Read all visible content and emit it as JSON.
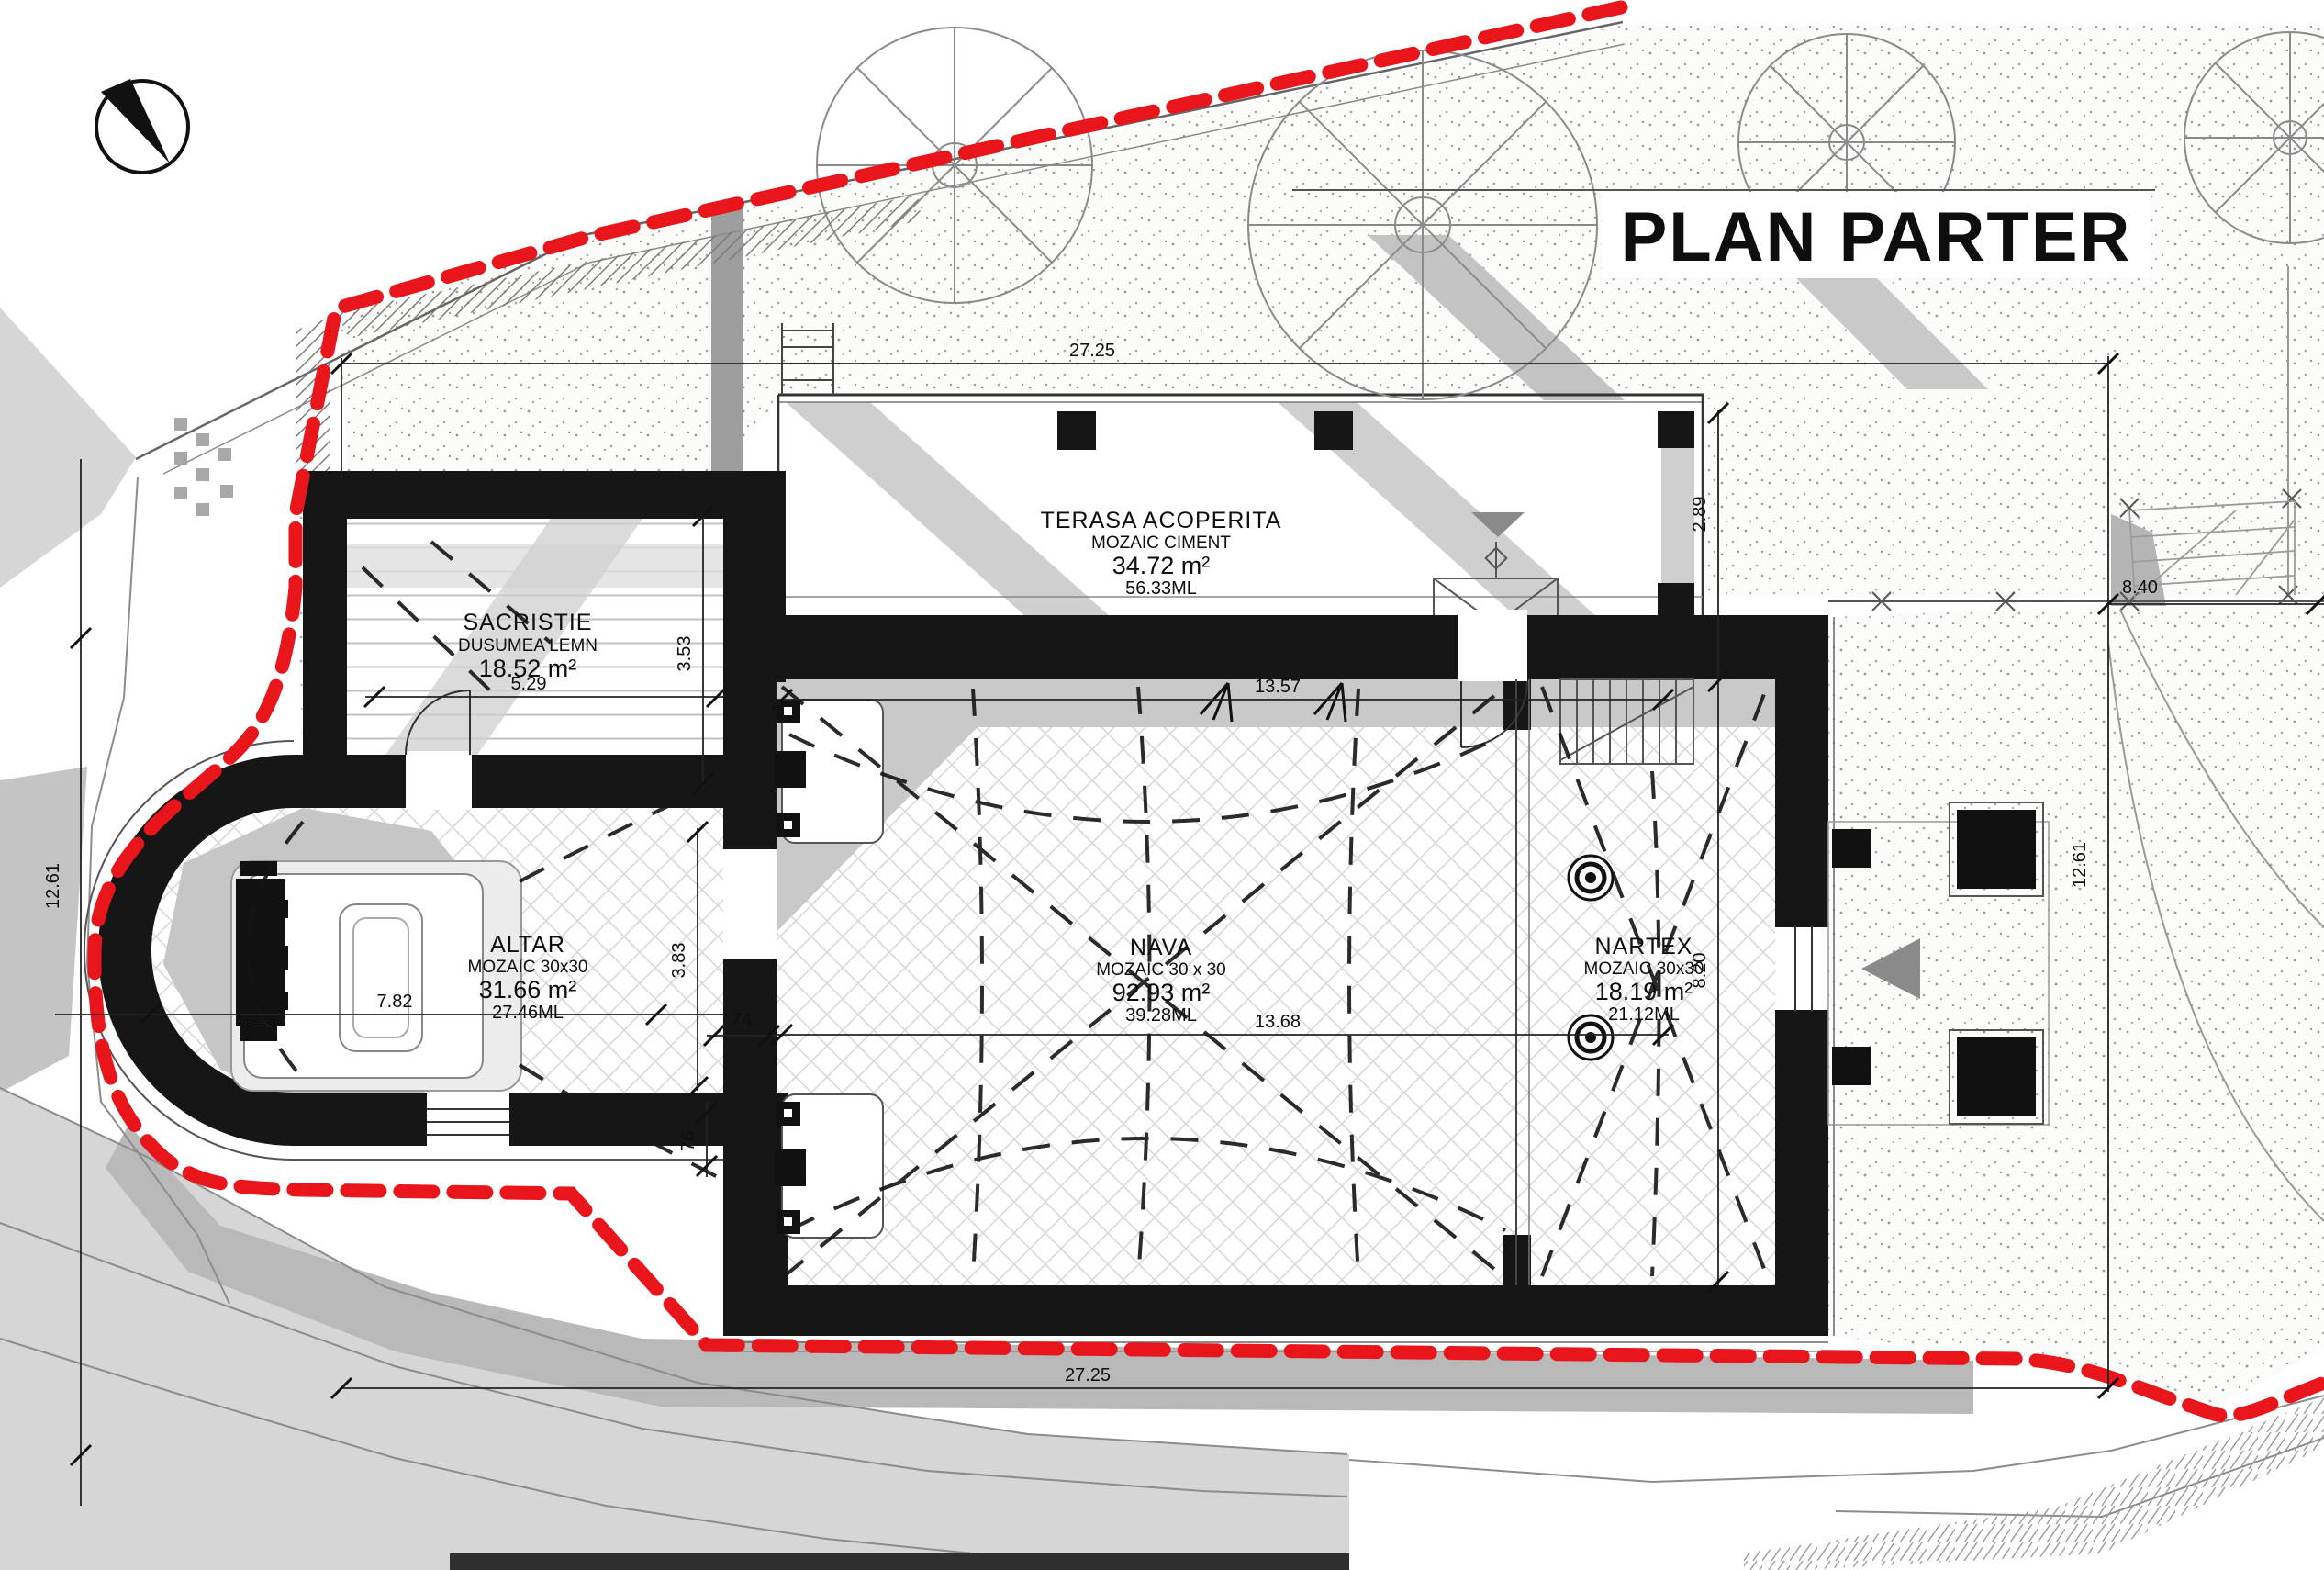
{
  "sheet": {
    "title": "PLAN PARTER"
  },
  "colors": {
    "boundary_red": "#e8151b",
    "wall_black": "#161616",
    "shadow_gray": "#bdbdbd",
    "paper": "#ffffff"
  },
  "rooms": {
    "sacristie": {
      "name": "SACRISTIE",
      "finish": "DUSUMEA LEMN",
      "area": "18.52 m²",
      "perimeter": "17.60ML"
    },
    "terasa": {
      "name": "TERASA ACOPERITA",
      "finish": "MOZAIC CIMENT",
      "area": "34.72 m²",
      "perimeter": "56.33ML"
    },
    "altar": {
      "name": "ALTAR",
      "finish": "MOZAIC 30x30",
      "area": "31.66 m²",
      "perimeter": "27.46ML"
    },
    "nava": {
      "name": "NAVA",
      "finish": "MOZAIC 30 x 30",
      "area": "92.93 m²",
      "perimeter": "39.28ML"
    },
    "nartex": {
      "name": "NARTEX",
      "finish": "MOZAIC 30x30",
      "area": "18.19 m²",
      "perimeter": "21.12ML"
    }
  },
  "dimensions": {
    "top": "27.25",
    "bottom": "27.25",
    "left": "12.61",
    "right": "12.61",
    "upper_right": "8.40",
    "terrace_depth": "2.89",
    "sacristie_width": "5.29",
    "sacristie_depth": "3.53",
    "apse_depth": "7.82",
    "altar_depth": "3.83",
    "wall_a": "74",
    "wall_b": "76",
    "nava_width_upper": "13.57",
    "nava_width_lower": "13.68",
    "nartex_depth": "8.20"
  }
}
